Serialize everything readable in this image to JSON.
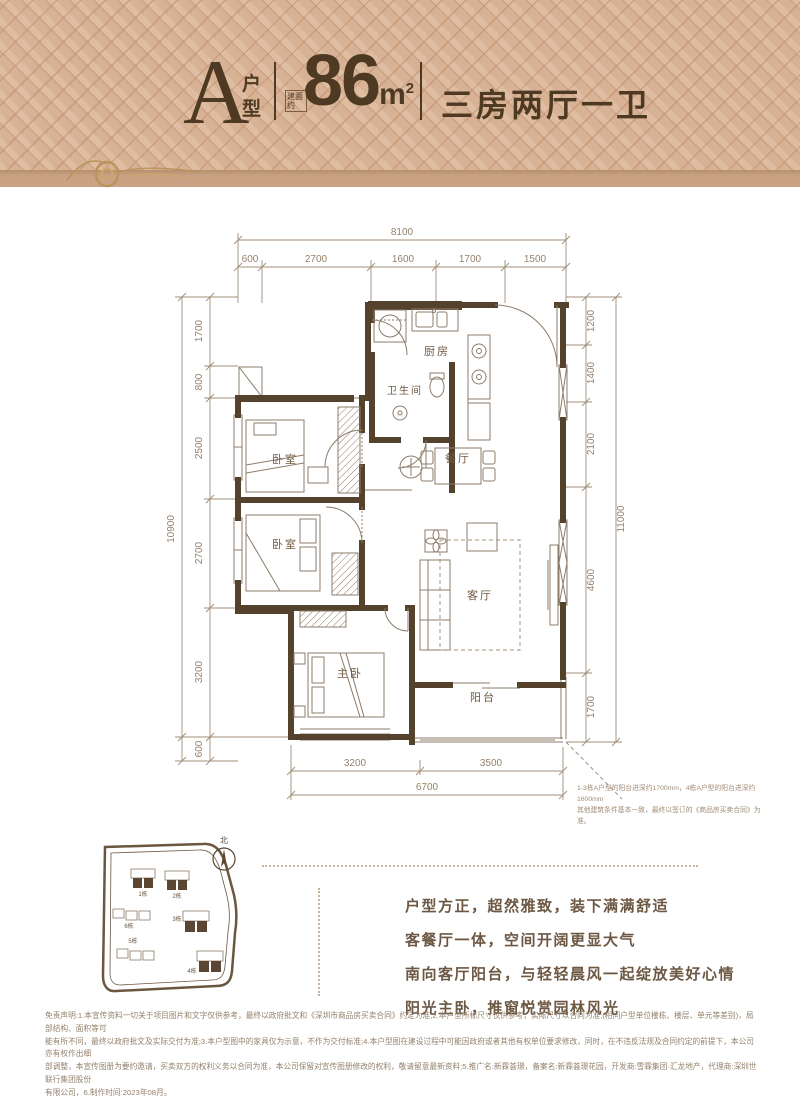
{
  "header": {
    "type_letter": "A",
    "type_label_1": "户",
    "type_label_2": "型",
    "area_prefix": "建面约",
    "area_value": "86",
    "area_unit": "m",
    "area_unit_sup": "2",
    "layout_label": "三房两厅一卫"
  },
  "floorplan": {
    "rooms": {
      "kitchen": "厨房",
      "bathroom": "卫生间",
      "dining": "餐厅",
      "bedroom1": "卧室",
      "bedroom2": "卧室",
      "living": "客厅",
      "master": "主卧",
      "balcony": "阳台"
    },
    "dims": {
      "top": {
        "total": "8100",
        "segments": [
          "600",
          "2700",
          "1600",
          "1700",
          "1500"
        ]
      },
      "left": {
        "total": "10900",
        "segments": [
          "1700",
          "800",
          "2500",
          "2700",
          "3200",
          "600"
        ]
      },
      "right": {
        "total": "11000",
        "segments": [
          "1200",
          "1400",
          "2100",
          "4600",
          "1700"
        ]
      },
      "bottom": {
        "total": "6700",
        "segments": [
          "3200",
          "3500"
        ]
      }
    },
    "note_line1": "1-3栋A户型的阳台进深约1700mm，4栋A户型的阳台进深约1600mm",
    "note_line2": "其他建筑条件基本一致，最终以签订的《商品房买卖合同》为准。"
  },
  "siteplan": {
    "north_label": "北",
    "buildings": [
      {
        "id": "1栋",
        "highlight": true
      },
      {
        "id": "2栋",
        "highlight": true
      },
      {
        "id": "3栋",
        "highlight": true
      },
      {
        "id": "4栋",
        "highlight": true
      },
      {
        "id": "5栋",
        "highlight": false
      },
      {
        "id": "6栋",
        "highlight": false
      }
    ]
  },
  "marketing": {
    "line1": "户型方正，超然雅致，装下满满舒适",
    "line2": "客餐厅一体，空间开阔更显大气",
    "line3": "南向客厅阳台，与轻轻晨风一起绽放美好心情",
    "line4": "阳光主卧，推窗悦赏园林风光"
  },
  "disclaimer": {
    "line1": "免责声明:1.本宣传资料一切关于项目图片和文字仅供参考，最终以政府批文和《深圳市商品房买卖合同》约定为准;2.本户型所标尺寸仅供参考，实际尺寸以合同为准;(相同户型单位楼栋、楼层、单元等差别)，局部结构、面积等可",
    "line2": "能有所不同，最终以政府批文及实际交付为准;3.本户型图中的家具仅为示意，不作为交付标准;4.本户型图在建设过程中可能因政府或者其他有权单位要求修改，同时，在不违反法规及合同约定的前提下，本公司亦有权作出细",
    "line3": "部调整，本宣传图册为要约邀请，买卖双方的权利义务以合同为准，本公司保留对宣传图册修改的权利，敬请留意最新资料;5.推广名:新霖荟璟，备案名:新霖荟璟花园，开发商:雪霖集团·汇龙地产，代理商:深圳世联行集团股份",
    "line4": "有限公司，6.制作时间:2023年08月。"
  },
  "colors": {
    "accent": "#4e3a22",
    "pattern_bg": "#d8b295",
    "wall": "#55422d",
    "line": "#8d7b69",
    "dim_text": "#95816b"
  }
}
